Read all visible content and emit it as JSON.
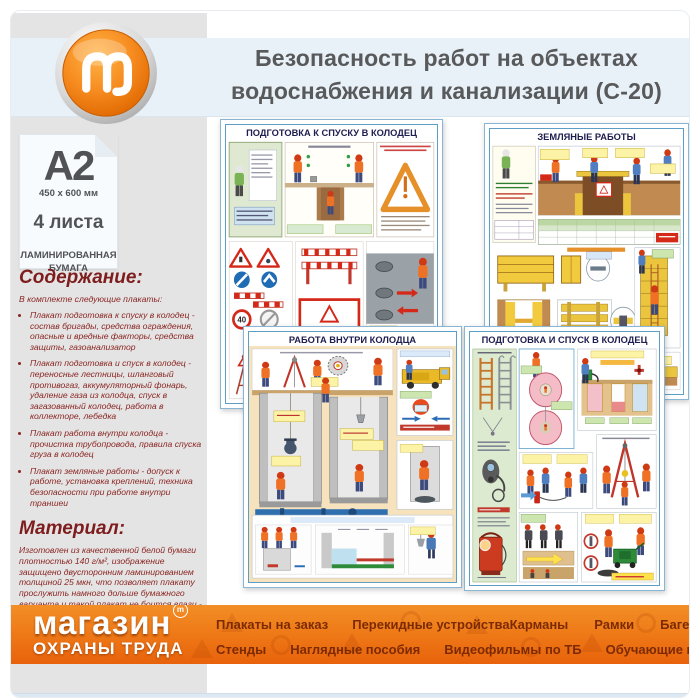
{
  "header": {
    "logo_letter": "m",
    "title_line1": "Безопасность работ на объектах",
    "title_line2": "водоснабжения и канализации (С-20)"
  },
  "format_card": {
    "size": "А2",
    "dimensions": "450 x 600 мм",
    "sheets": "4 листа",
    "paper_line1": "ЛАМИНИРОВАННАЯ",
    "paper_line2": "БУМАГА"
  },
  "contents": {
    "heading": "Содержание:",
    "intro": "В комплекте следующие плакаты:",
    "items": [
      "Плакат подготовка к спуску в колодец - состав бригады, средства ограждения, опасные и вредные факторы, средства защиты, газоанализатор",
      "Плакат подготовка и спуск в колодец - переносные лестницы, шланговый противогаз, аккумуляторный фонарь, удаление газа из колодца, спуск в загазованный колодец, работа в коллекторе, лебедка",
      "Плакат работа внутри колодца - прочистка трубопровода, правила спуска груза в колодец",
      "Плакат земляные работы - допуск к работе, установка креплений, техника безопасности при работе внутри траншеи"
    ]
  },
  "material": {
    "heading": "Материал:",
    "text": "Изготовлен из качественной белой бумаги плотностью 140 г/м², изображение защищено двусторонним ламинированием толщиной 25 мкн, что позволяет плакату прослужить намного дольше бумажного варианта и такой плакат не боится влаги - его смело можно протирать."
  },
  "posters": [
    {
      "title": "ПОДГОТОВКА К СПУСКУ В КОЛОДЕЦ",
      "speed_sign": "40"
    },
    {
      "title": "ЗЕМЛЯНЫЕ РАБОТЫ"
    },
    {
      "title": "РАБОТА ВНУТРИ КОЛОДЦА"
    },
    {
      "title": "ПОДГОТОВКА И СПУСК В КОЛОДЕЦ"
    }
  ],
  "footer": {
    "logo_line1": "магазин",
    "logo_line2": "ОХРАНЫ ТРУДА",
    "tm_letter": "m",
    "menu_row1": [
      "Плакаты на заказ",
      "Перекидные устройства",
      "Карманы",
      "Рамки",
      "Багет"
    ],
    "menu_row2": [
      "Стенды",
      "Наглядные пособия",
      "Видеофильмы по ТБ",
      "Обучающие программы"
    ]
  },
  "colors": {
    "accent_orange": "#ee7214",
    "header_bg": "#e9f1f8",
    "sidebar_bg": "#e4e4e4",
    "title_text": "#58595b",
    "maroon_text": "#8a2623",
    "footer_menu_text": "#7c2a04",
    "poster_border": "#5e9dc6"
  }
}
